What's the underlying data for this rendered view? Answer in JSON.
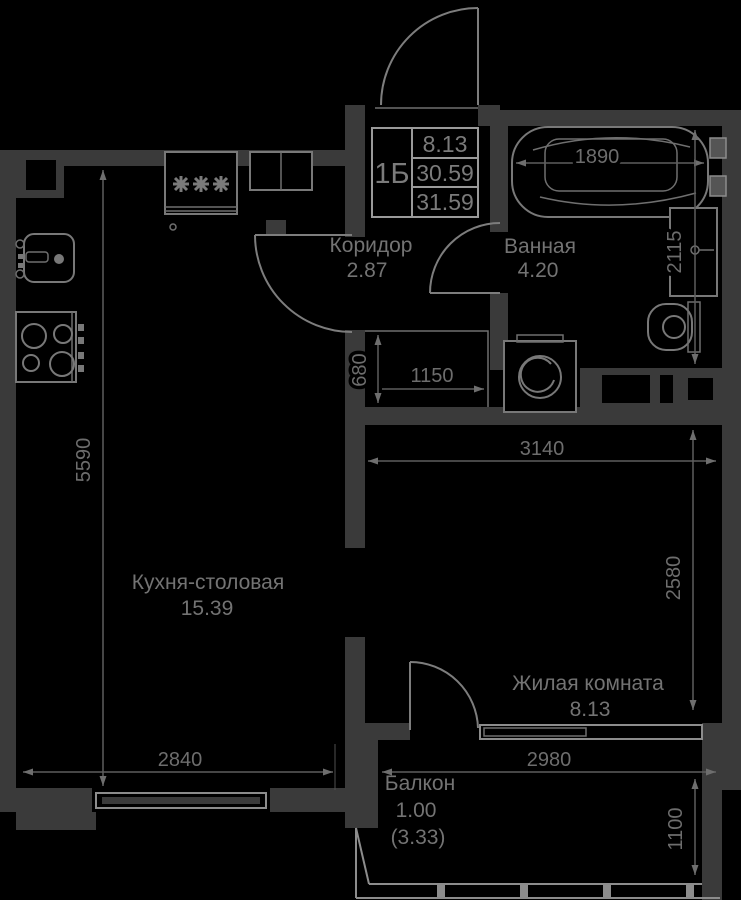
{
  "plan": {
    "title_block": {
      "flat_type": "1Б",
      "room_area": "8.13",
      "living_area": "30.59",
      "total_area": "31.59"
    },
    "rooms": {
      "corridor": {
        "name": "Коридор",
        "area": "2.87"
      },
      "bathroom": {
        "name": "Ванная",
        "area": "4.20"
      },
      "kitchen": {
        "name": "Кухня-столовая",
        "area": "15.39"
      },
      "living": {
        "name": "Жилая комната",
        "area": "8.13"
      },
      "balcony": {
        "name": "Балкон",
        "area": "1.00",
        "area_alt": "(3.33)"
      }
    },
    "dimensions": {
      "bath_length": "1890",
      "bathroom_depth": "2115",
      "closet_depth": "680",
      "closet_width": "1150",
      "kitchen_length": "5590",
      "kitchen_width": "2840",
      "living_width": "3140",
      "living_depth": "2580",
      "balcony_width": "2980",
      "balcony_depth": "1100"
    },
    "colors": {
      "background": "#000000",
      "walls": "#3a3a3a",
      "fixture_lines": "#787878",
      "dimension_text": "#6d6d6d",
      "title_border": "#9a9a9a"
    }
  }
}
